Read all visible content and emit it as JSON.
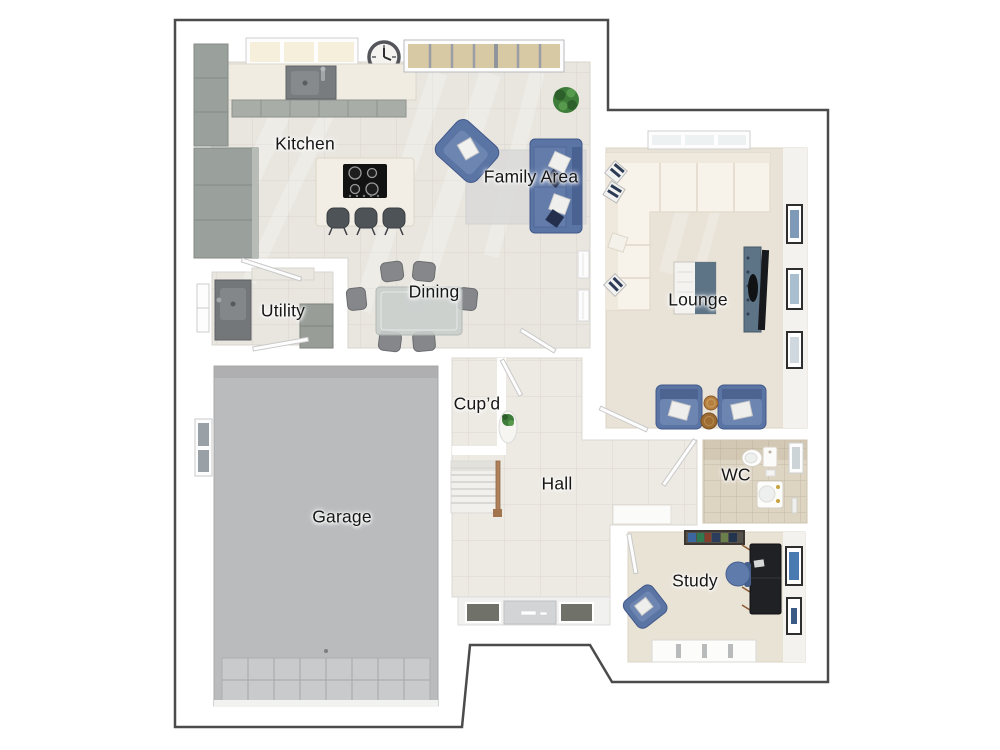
{
  "plan": {
    "type": "3d-floor-plan-top-view",
    "rooms": {
      "kitchen": {
        "label": "Kitchen"
      },
      "family_area": {
        "label": "Family Area"
      },
      "utility": {
        "label": "Utility"
      },
      "dining": {
        "label": "Dining"
      },
      "lounge": {
        "label": "Lounge"
      },
      "cupboard": {
        "label": "Cup’d"
      },
      "hall": {
        "label": "Hall"
      },
      "wc": {
        "label": "WC"
      },
      "garage": {
        "label": "Garage"
      },
      "study": {
        "label": "Study"
      }
    }
  },
  "colors": {
    "outline": "#4b4b4b",
    "wall": "#ffffff",
    "tile_floor": "#e9e6e0",
    "hall_floor": "#edeae3",
    "carpet": "#e9e3d7",
    "wc_floor": "#ddd4c2",
    "garage_floor": "#babbbd",
    "cabinet_gray": "#9aa09b",
    "sofa_blue": "#5a74a4",
    "accent_slate": "#5d7386",
    "handrail_wood": "#b0805a",
    "label_text": "#161616"
  }
}
